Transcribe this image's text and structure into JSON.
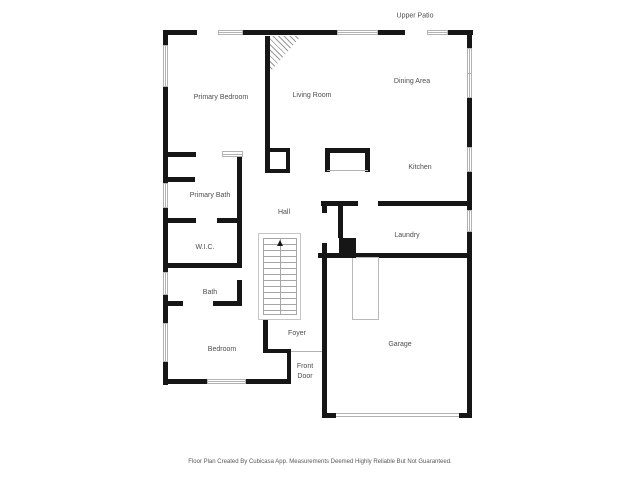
{
  "footer": {
    "text": "Floor Plan Created By Cubicasa App. Measurements Deemed Highly Reliable But Not Guaranteed."
  },
  "plan": {
    "colors": {
      "wall": "#161616",
      "label": "#4d4d4d",
      "window_border": "#b3b3b3",
      "stair_line": "#a6a6a6"
    },
    "outdoor_labels": [
      {
        "id": "upper-patio",
        "text": "Upper Patio",
        "x": 415,
        "y": 16
      }
    ],
    "room_labels": [
      {
        "id": "primary-bedroom",
        "text": "Primary Bedroom",
        "x": 221,
        "y": 98
      },
      {
        "id": "living-room",
        "text": "Living Room",
        "x": 312,
        "y": 96
      },
      {
        "id": "dining-area",
        "text": "Dining Area",
        "x": 412,
        "y": 82
      },
      {
        "id": "kitchen",
        "text": "Kitchen",
        "x": 420,
        "y": 168
      },
      {
        "id": "primary-bath",
        "text": "Primary Bath",
        "x": 210,
        "y": 196
      },
      {
        "id": "hall",
        "text": "Hall",
        "x": 284,
        "y": 213
      },
      {
        "id": "laundry",
        "text": "Laundry",
        "x": 407,
        "y": 236
      },
      {
        "id": "wic",
        "text": "W.I.C.",
        "x": 205,
        "y": 248
      },
      {
        "id": "bath",
        "text": "Bath",
        "x": 210,
        "y": 293
      },
      {
        "id": "bedroom",
        "text": "Bedroom",
        "x": 222,
        "y": 350
      },
      {
        "id": "foyer",
        "text": "Foyer",
        "x": 297,
        "y": 334
      },
      {
        "id": "front-door",
        "text": "Front\nDoor",
        "x": 305,
        "y": 372
      },
      {
        "id": "garage",
        "text": "Garage",
        "x": 400,
        "y": 345
      }
    ],
    "walls": [
      [
        163,
        30,
        34,
        5
      ],
      [
        243,
        30,
        94,
        5
      ],
      [
        378,
        30,
        27,
        5
      ],
      [
        448,
        30,
        25,
        5
      ],
      [
        163,
        30,
        5,
        15
      ],
      [
        163,
        87,
        5,
        96
      ],
      [
        163,
        208,
        5,
        64
      ],
      [
        163,
        295,
        5,
        28
      ],
      [
        163,
        362,
        5,
        23
      ],
      [
        467,
        30,
        5,
        18
      ],
      [
        467,
        98,
        5,
        49
      ],
      [
        467,
        172,
        5,
        38
      ],
      [
        467,
        232,
        5,
        186
      ],
      [
        163,
        379,
        44,
        5
      ],
      [
        246,
        379,
        45,
        5
      ],
      [
        322,
        413,
        14,
        5
      ],
      [
        459,
        413,
        13,
        5
      ],
      [
        265,
        36,
        5,
        117
      ],
      [
        265,
        148,
        5,
        25
      ],
      [
        266,
        148,
        24,
        4
      ],
      [
        286,
        148,
        4,
        25
      ],
      [
        266,
        169,
        24,
        4
      ],
      [
        166,
        152,
        30,
        5
      ],
      [
        166,
        177,
        29,
        5
      ],
      [
        237,
        152,
        5,
        113
      ],
      [
        237,
        280,
        5,
        26
      ],
      [
        166,
        218,
        30,
        5
      ],
      [
        217,
        218,
        23,
        5
      ],
      [
        166,
        263,
        76,
        5
      ],
      [
        164,
        301,
        19,
        5
      ],
      [
        213,
        301,
        28,
        5
      ],
      [
        263,
        302,
        5,
        51
      ],
      [
        263,
        349,
        28,
        4
      ],
      [
        287,
        351,
        4,
        33
      ],
      [
        322,
        201,
        5,
        12
      ],
      [
        322,
        243,
        5,
        175
      ],
      [
        321,
        201,
        37,
        5
      ],
      [
        378,
        201,
        89,
        5
      ],
      [
        338,
        206,
        5,
        32
      ],
      [
        318,
        253,
        149,
        5
      ],
      [
        325,
        148,
        45,
        5
      ],
      [
        325,
        148,
        5,
        24
      ],
      [
        365,
        148,
        5,
        24
      ]
    ],
    "windows": [
      {
        "x": 218,
        "y": 30,
        "w": 25,
        "h": 5,
        "axis": "h"
      },
      {
        "x": 337,
        "y": 30,
        "w": 41,
        "h": 5,
        "axis": "h"
      },
      {
        "x": 427,
        "y": 30,
        "w": 21,
        "h": 5,
        "axis": "h"
      },
      {
        "x": 222,
        "y": 151,
        "w": 21,
        "h": 6,
        "axis": "h"
      },
      {
        "x": 163,
        "y": 45,
        "w": 5,
        "h": 42,
        "axis": "v"
      },
      {
        "x": 163,
        "y": 183,
        "w": 5,
        "h": 25,
        "axis": "v"
      },
      {
        "x": 163,
        "y": 272,
        "w": 5,
        "h": 23,
        "axis": "v"
      },
      {
        "x": 163,
        "y": 323,
        "w": 5,
        "h": 39,
        "axis": "v"
      },
      {
        "x": 467,
        "y": 48,
        "w": 5,
        "h": 50,
        "axis": "v",
        "split": true
      },
      {
        "x": 467,
        "y": 147,
        "w": 5,
        "h": 25,
        "axis": "v"
      },
      {
        "x": 467,
        "y": 210,
        "w": 5,
        "h": 22,
        "axis": "v"
      },
      {
        "x": 207,
        "y": 379,
        "w": 39,
        "h": 5,
        "axis": "h"
      }
    ],
    "fixtures": {
      "stairs_outer": {
        "x": 258,
        "y": 233,
        "w": 43,
        "h": 87
      },
      "stairs": {
        "x": 263,
        "y": 238,
        "w": 34,
        "h": 77
      },
      "fireplace": {
        "x": 270,
        "y": 36,
        "w": 31,
        "h": 36
      },
      "furnace": {
        "x": 352,
        "y": 257,
        "w": 27,
        "h": 63
      },
      "chimney_block": {
        "x": 339,
        "y": 238,
        "w": 17,
        "h": 20
      }
    },
    "thin_lines": [
      {
        "x": 291,
        "y": 351,
        "w": 31,
        "h": 1
      },
      {
        "x": 327,
        "y": 170,
        "w": 41,
        "h": 1
      },
      {
        "x": 336,
        "y": 413,
        "w": 123,
        "h": 1
      },
      {
        "x": 336,
        "y": 416,
        "w": 123,
        "h": 1
      }
    ]
  }
}
